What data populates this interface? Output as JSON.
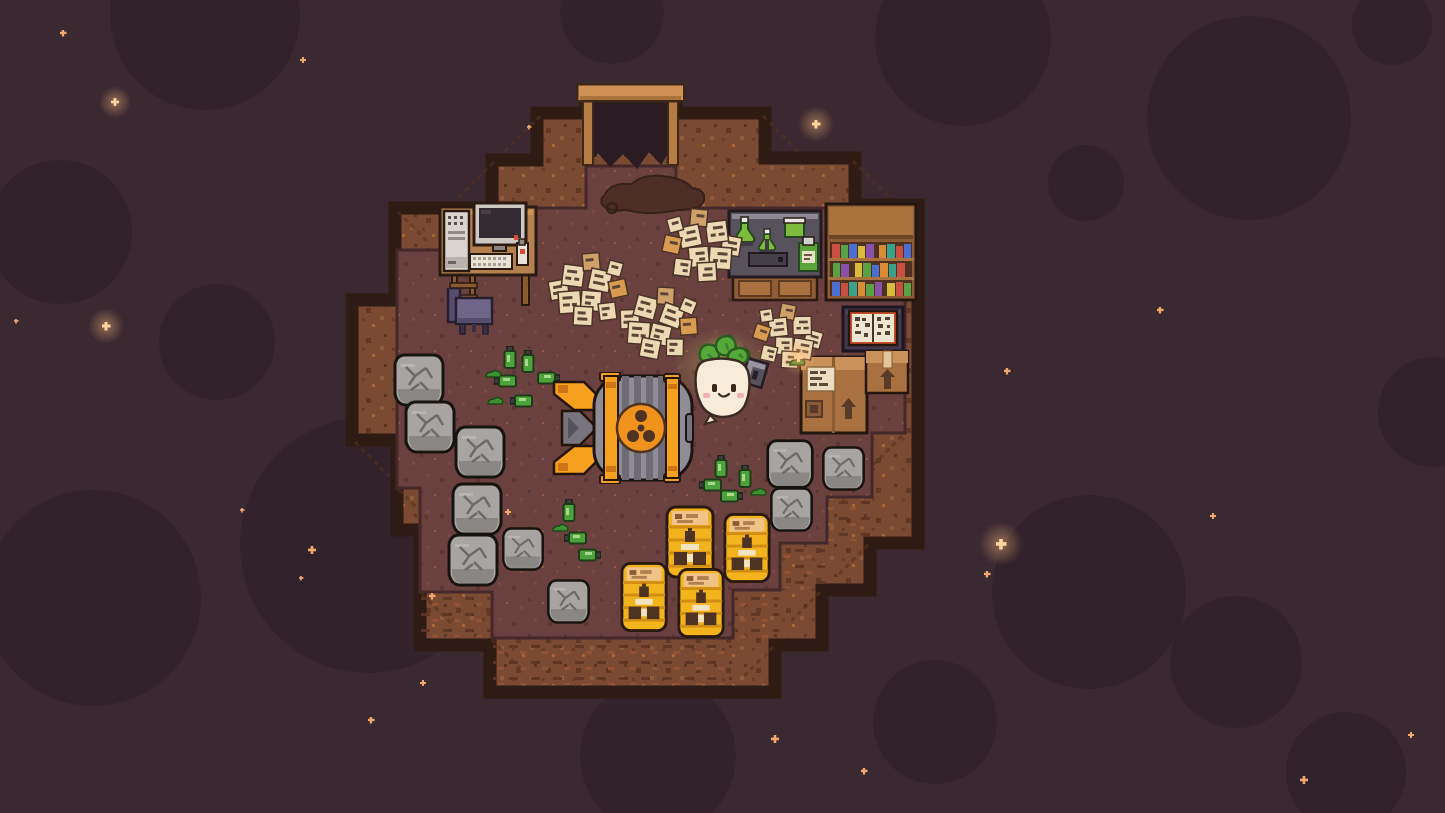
{
  "scene": {
    "labels": {
      "viewport": "pixel-art cave hideout in dark cavern",
      "background": "dark cavern background with craters and sparkles",
      "room": "stepped stone room",
      "wall": "cave wall",
      "floor": "cave floor",
      "entrance": "mine entrance with wooden frame",
      "desk": "desk with computer, keyboard and tower",
      "chair": "purple chair",
      "chem_table": "laboratory table with green flasks",
      "bookshelf": "bookshelf with colorful books",
      "book_stand": "stand with open book",
      "box_large": "large cardboard box with label and up arrow",
      "box_small": "small cardboard box with up arrow",
      "paper_pile": "pile of scattered notes",
      "rock": "cracked gray boulder",
      "bomb": "large bomb with radiation emblem",
      "barrel": "yellow radioactive waste barrel",
      "bottle_up": "green bottle standing",
      "bottle_down": "green bottle tipped over",
      "sludge": "green sludge blob",
      "character": "smiling turnip character with glowing leaves",
      "device": "handheld detector",
      "spark": "orange sparkle near detector"
    },
    "inventory": {
      "rocks": 10,
      "barrels": 4,
      "paper_piles": 4,
      "bottles_standing": 5,
      "bottles_tipped": 9,
      "sludge_blobs": 5,
      "bookshelf_rows": 3,
      "boxes": 2,
      "flasks_on_table": 4
    },
    "palette": {
      "wall": "#7b4a32",
      "wall_dark": "#633823",
      "floor": "#6b4140",
      "border": "#2d1b14",
      "wood_light": "#cf9455",
      "wood_mid": "#b5824f",
      "wood_dark": "#8f5c35",
      "cardboard": "#a8713f",
      "rock_gray": "#a8a4a2",
      "barrel_yellow": "#f2b31d",
      "bomb_orange": "#f0931e",
      "bomb_gray": "#8f8c96",
      "bottle_green": "#4ea23b",
      "paper_cream": "#ecd9b4",
      "book_red": "#c94f43",
      "book_green": "#5aa243",
      "book_blue": "#4a6fd1",
      "book_purple": "#8a51a8",
      "book_orange": "#d98c35",
      "book_teal": "#3aa18c",
      "book_yellow": "#d9bb3a",
      "turnip_body": "#f7ecd7",
      "leaf_green": "#55a83a",
      "glow_green": "#d8e85c",
      "chair_purple": "#6e6589",
      "chem_top": "#57525c"
    },
    "environment": {
      "background": "#3b2932",
      "crater": "#32222b",
      "sparkle": "#f2a96e",
      "sparkle_bright": "#ffd3a0",
      "craters": [
        {
          "x": 205,
          "y": 15,
          "r": 95
        },
        {
          "x": 612,
          "y": 12,
          "r": 52
        },
        {
          "x": 963,
          "y": 38,
          "r": 88
        },
        {
          "x": 1249,
          "y": 118,
          "r": 102
        },
        {
          "x": 1392,
          "y": 25,
          "r": 40
        },
        {
          "x": 60,
          "y": 232,
          "r": 72
        },
        {
          "x": 217,
          "y": 342,
          "r": 58
        },
        {
          "x": 1086,
          "y": 183,
          "r": 38
        },
        {
          "x": 368,
          "y": 545,
          "r": 128
        },
        {
          "x": 93,
          "y": 598,
          "r": 108
        },
        {
          "x": 658,
          "y": 756,
          "r": 78
        },
        {
          "x": 935,
          "y": 722,
          "r": 62
        },
        {
          "x": 1089,
          "y": 592,
          "r": 97
        },
        {
          "x": 1236,
          "y": 662,
          "r": 66
        },
        {
          "x": 1346,
          "y": 772,
          "r": 60
        },
        {
          "x": 1433,
          "y": 412,
          "r": 55
        }
      ],
      "sparkles": [
        {
          "x": 63,
          "y": 33,
          "s": 7
        },
        {
          "x": 303,
          "y": 60,
          "s": 6
        },
        {
          "x": 115,
          "y": 102,
          "s": 8,
          "b": 1
        },
        {
          "x": 816,
          "y": 124,
          "s": 9,
          "b": 1
        },
        {
          "x": 529,
          "y": 127,
          "s": 5
        },
        {
          "x": 1160,
          "y": 310,
          "s": 7
        },
        {
          "x": 106,
          "y": 326,
          "s": 9,
          "b": 1
        },
        {
          "x": 16,
          "y": 321,
          "s": 5
        },
        {
          "x": 1007,
          "y": 371,
          "s": 7
        },
        {
          "x": 1213,
          "y": 516,
          "s": 6
        },
        {
          "x": 1001,
          "y": 544,
          "s": 11,
          "b": 1
        },
        {
          "x": 987,
          "y": 574,
          "s": 7
        },
        {
          "x": 312,
          "y": 550,
          "s": 8
        },
        {
          "x": 301,
          "y": 578,
          "s": 5
        },
        {
          "x": 242,
          "y": 510,
          "s": 5
        },
        {
          "x": 371,
          "y": 720,
          "s": 7
        },
        {
          "x": 775,
          "y": 739,
          "s": 8
        },
        {
          "x": 864,
          "y": 771,
          "s": 7
        },
        {
          "x": 1304,
          "y": 780,
          "s": 8
        },
        {
          "x": 1411,
          "y": 735,
          "s": 6
        },
        {
          "x": 508,
          "y": 512,
          "s": 6
        },
        {
          "x": 432,
          "y": 596,
          "s": 7
        },
        {
          "x": 423,
          "y": 683,
          "s": 6
        }
      ]
    }
  }
}
